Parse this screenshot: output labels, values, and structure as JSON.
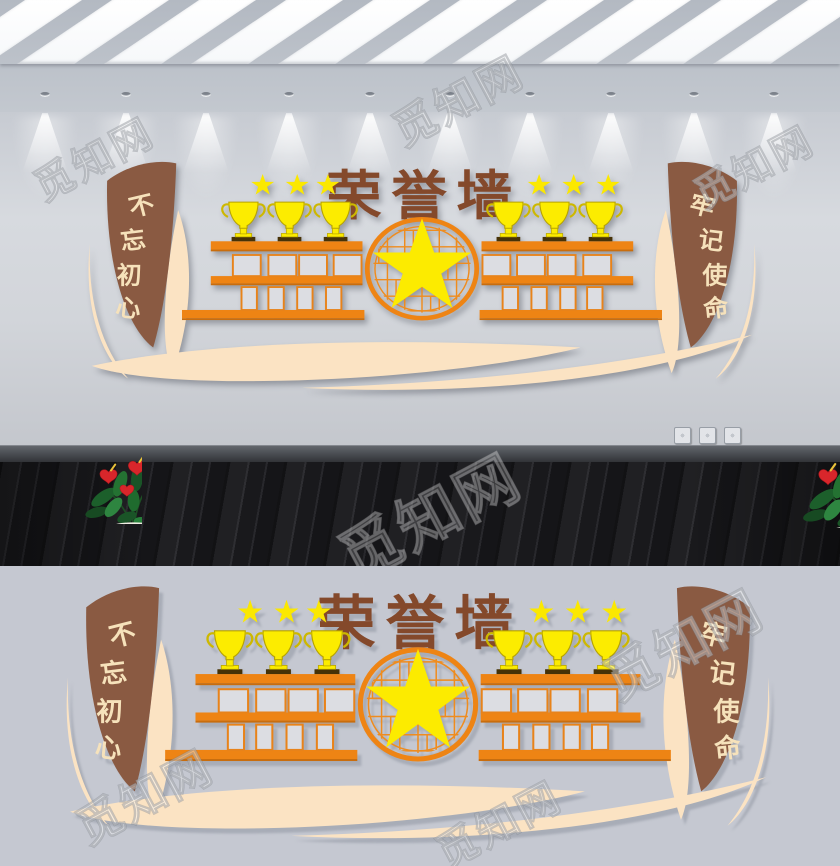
{
  "design": {
    "title": "荣誉墙",
    "banner_left": {
      "text": "不忘初心",
      "chars": [
        "不",
        "忘",
        "初",
        "心"
      ]
    },
    "banner_right": {
      "text": "牢记使命",
      "chars": [
        "牢",
        "记",
        "使",
        "命"
      ]
    },
    "stars_left": 3,
    "stars_right": 3,
    "shelf_left": {
      "trophies": 3,
      "photo_slots_middle": 4,
      "photo_slots_bottom": 4
    },
    "shelf_right": {
      "trophies": 3,
      "photo_slots_middle": 4,
      "photo_slots_bottom": 4
    },
    "colors": {
      "banner_brown": "#8a5a42",
      "title_brown": "#84492b",
      "shelf_orange": "#ee8414",
      "trophy_yellow": "#fcec00",
      "star_yellow": "#fceb00",
      "ribbon_cream": "#fbe3c3",
      "frame_gray": "#dcdde2"
    }
  },
  "scene": {
    "skylight_panels": 10,
    "spotlights": 10,
    "outlets": 3,
    "plants": 2
  },
  "watermark": {
    "text": "觅知网"
  }
}
